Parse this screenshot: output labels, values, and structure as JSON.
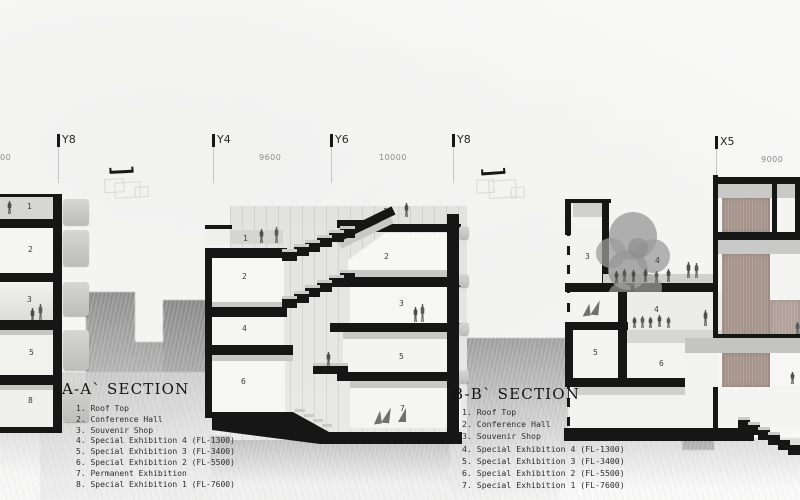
{
  "grid": {
    "markers": [
      {
        "label": "Y8"
      },
      {
        "label": "Y4"
      },
      {
        "label": "Y6"
      },
      {
        "label": "Y8"
      },
      {
        "label": "X5"
      }
    ],
    "dimensions": [
      {
        "label": "00"
      },
      {
        "label": "9600"
      },
      {
        "label": "10000"
      },
      {
        "label": "9000"
      }
    ]
  },
  "section_a": {
    "title": "A-A` SECTION",
    "legend": [
      "1. Roof Top",
      "2. Conference Hall",
      "3. Souvenir Shop",
      "4. Special Exhibition 4 (FL-1300)",
      "5. Special Exhibition 3 (FL-3400)",
      "6. Special Exhibition 2 (FL-5500)",
      "7. Permanent Exhibition",
      "8. Special Exhibition 1 (FL-7600)"
    ]
  },
  "section_b": {
    "title": "B-B` SECTION",
    "legend": [
      "1. Roof Top",
      "2. Conference Hall",
      "3. Souvenir Shop",
      "4. Special Exhibition 4 (FL-1300)",
      "5. Special Exhibition 3 (FL-3400)",
      "6. Special Exhibition 2 (FL-5500)",
      "7. Special Exhibition 1 (FL-7600)"
    ]
  },
  "rooms": {
    "left": [
      "1",
      "2",
      "3",
      "5",
      "8"
    ],
    "mid_left": [
      "1",
      "2",
      "4",
      "6"
    ],
    "mid_right": [
      "1",
      "2",
      "3",
      "5",
      "7"
    ],
    "right": [
      "3",
      "4",
      "4",
      "5",
      "6"
    ]
  },
  "colors": {
    "ink": "#161616",
    "band_gray": "#c9c9c7",
    "brick": "#a5938c",
    "terrain_gray": "#9a9a9a"
  }
}
